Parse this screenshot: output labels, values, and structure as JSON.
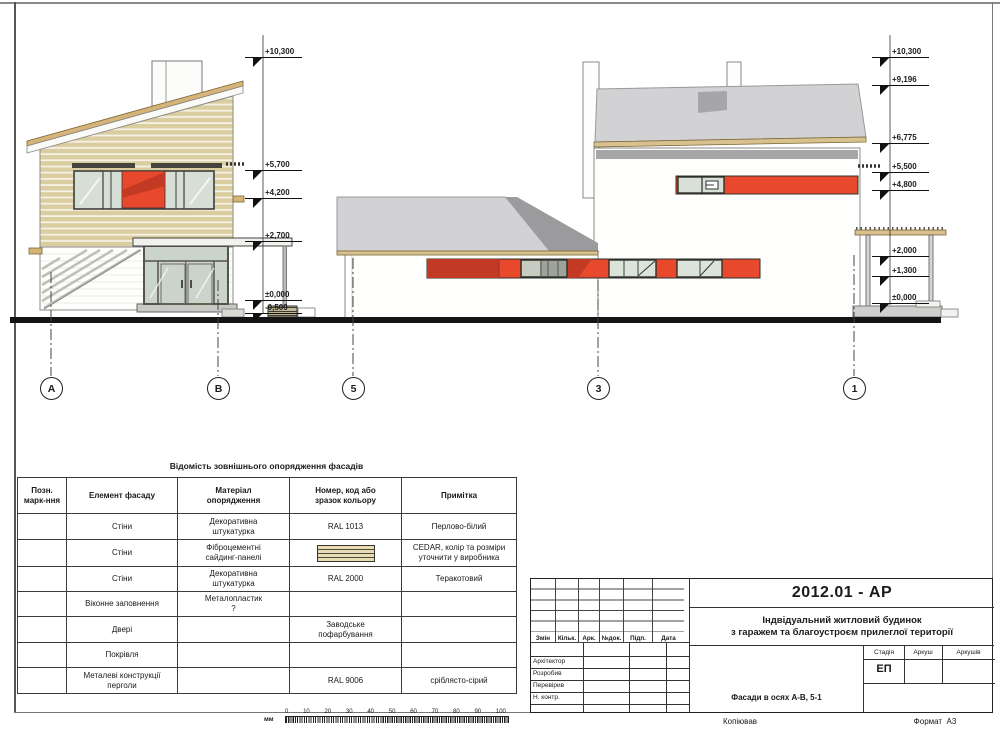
{
  "sheet": {
    "copied_label": "Копіював",
    "format_label": "Формат",
    "format_value": "А3"
  },
  "elevations": {
    "left": [
      "+10,300",
      "+5,700",
      "+4,200",
      "+2,700",
      "±0,000",
      "-0,500"
    ],
    "right": [
      "+10,300",
      "+9,196",
      "+6,775",
      "+5,500",
      "+4,800",
      "+2,000",
      "+1,300",
      "±0,000"
    ]
  },
  "axes": [
    "А",
    "В",
    "5",
    "3",
    "1"
  ],
  "finish_table": {
    "title": "Відомість зовнішнього опорядження фасадів",
    "headers": [
      "Позн.\nмарк-ння",
      "Елемент фасаду",
      "Матеріал\nопорядження",
      "Номер, код або\nзразок кольору",
      "Примітка"
    ],
    "rows": [
      {
        "mark": "",
        "element": "Стіни",
        "material": "Декоративна\nштукатурка",
        "code": "RAL 1013",
        "note": "Перлово-білий"
      },
      {
        "mark": "",
        "element": "Стіни",
        "material": "Фіброцементні\nсайдинг-панелі",
        "code": "",
        "note": "CEDAR, колір та розміри\nуточнити у виробника"
      },
      {
        "mark": "",
        "element": "Стіни",
        "material": "Декоративна\nштукатурка",
        "code": "RAL 2000",
        "note": "Теракотовий"
      },
      {
        "mark": "",
        "element": "Віконне заповнення",
        "material": "Металопластик\n?",
        "code": "",
        "note": ""
      },
      {
        "mark": "",
        "element": "Двері",
        "material": "",
        "code": "Заводське\nпофарбування",
        "note": ""
      },
      {
        "mark": "",
        "element": "Покрівля",
        "material": "",
        "code": "",
        "note": ""
      },
      {
        "mark": "",
        "element": "Металеві конструкції\nперголи",
        "material": "",
        "code": "RAL 9006",
        "note": "сріблясто-сірий"
      }
    ]
  },
  "title_block": {
    "code": "2012.01 - АР",
    "project_name_line1": "Індвідуальний житловий будинок",
    "project_name_line2": "з гаражем та благоустроєм прилеглої території",
    "sheet_name": "Фасади в осях А-В, 5-1",
    "rev_headers": [
      "Змін",
      "Кільк.",
      "Арк.",
      "№док.",
      "Підп.",
      "Дата"
    ],
    "roles": [
      "Архітектор",
      "Розробив",
      "Перевірив",
      "Н. контр."
    ],
    "stage_headers": [
      "Стадія",
      "Аркуш",
      "Аркушів"
    ],
    "stage_value": "ЕП"
  },
  "scale_bar": {
    "unit": "мм",
    "ticks": [
      "0",
      "10",
      "20",
      "30",
      "40",
      "50",
      "60",
      "70",
      "80",
      "90",
      "100"
    ]
  },
  "colors": {
    "accent_orange": "#E8492C",
    "accent_orange_dark": "#C23A23",
    "siding_tan": "#DACD9F",
    "wood_tan": "#D4B479",
    "roof_gray": "#D2D2D4",
    "roof_shadow": "#9B9B9D"
  }
}
